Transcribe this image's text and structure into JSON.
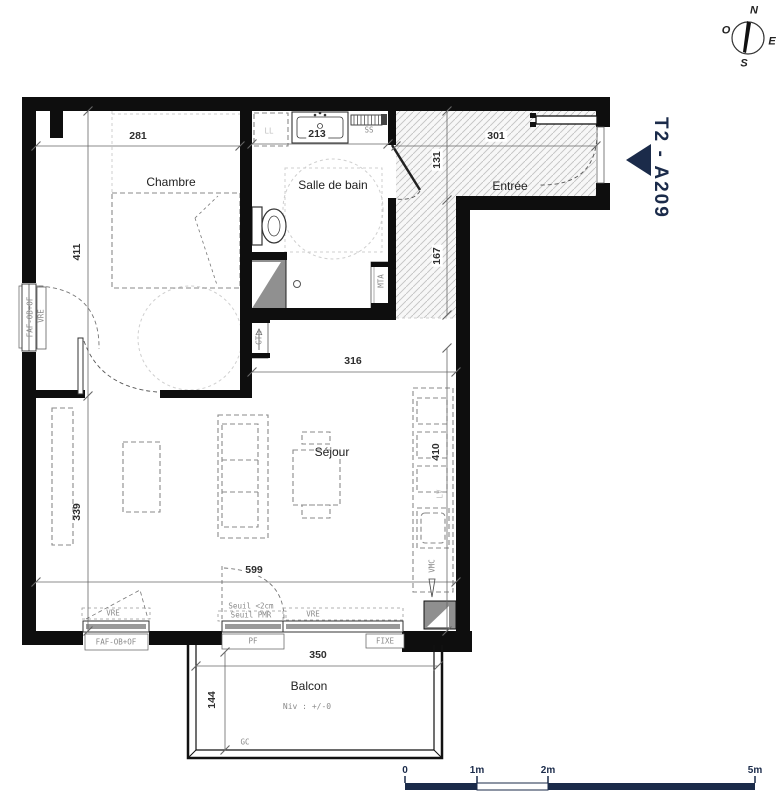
{
  "unit": {
    "label": "T2 - A209"
  },
  "compass": {
    "north": "N",
    "west": "O",
    "east": "E",
    "south": "S"
  },
  "rooms": {
    "chambre": "Chambre",
    "salle_de_bain": "Salle de bain",
    "entree": "Entrée",
    "sejour": "Séjour",
    "balcon": "Balcon"
  },
  "dimensions": {
    "chambre_width": "281",
    "sdb_width": "213",
    "entree_width": "301",
    "entree_depth_upper": "131",
    "entree_depth_lower": "167",
    "chambre_depth": "411",
    "sejour_top_width": "316",
    "sejour_right_depth": "410",
    "sejour_left_depth": "339",
    "sejour_width": "599",
    "balcon_width": "350",
    "balcon_depth": "144"
  },
  "annotations": {
    "ss": "SS",
    "ll": "LL",
    "gtl": "GTL",
    "mta": "MTA",
    "vmc": "VMC",
    "lv": "LV",
    "gc": "GC",
    "faf_left": "FAF-OB+OF",
    "faf_bottom": "FAF-OB+OF",
    "vre_left": "VRE",
    "vre_bottom_left": "VRE",
    "vre_bottom_mid": "VRE",
    "pf": "PF",
    "fixe": "FIXE",
    "seuil_height": "Seuil <2cm",
    "seuil_pmr": "Seuil PMR",
    "niveau": "Niv : +/-0"
  },
  "scale_bar": {
    "t0": "0",
    "t1": "1m",
    "t2": "2m",
    "t5": "5m"
  },
  "colors": {
    "navy": "#1b2b4a",
    "wall": "#0e0e0e"
  }
}
